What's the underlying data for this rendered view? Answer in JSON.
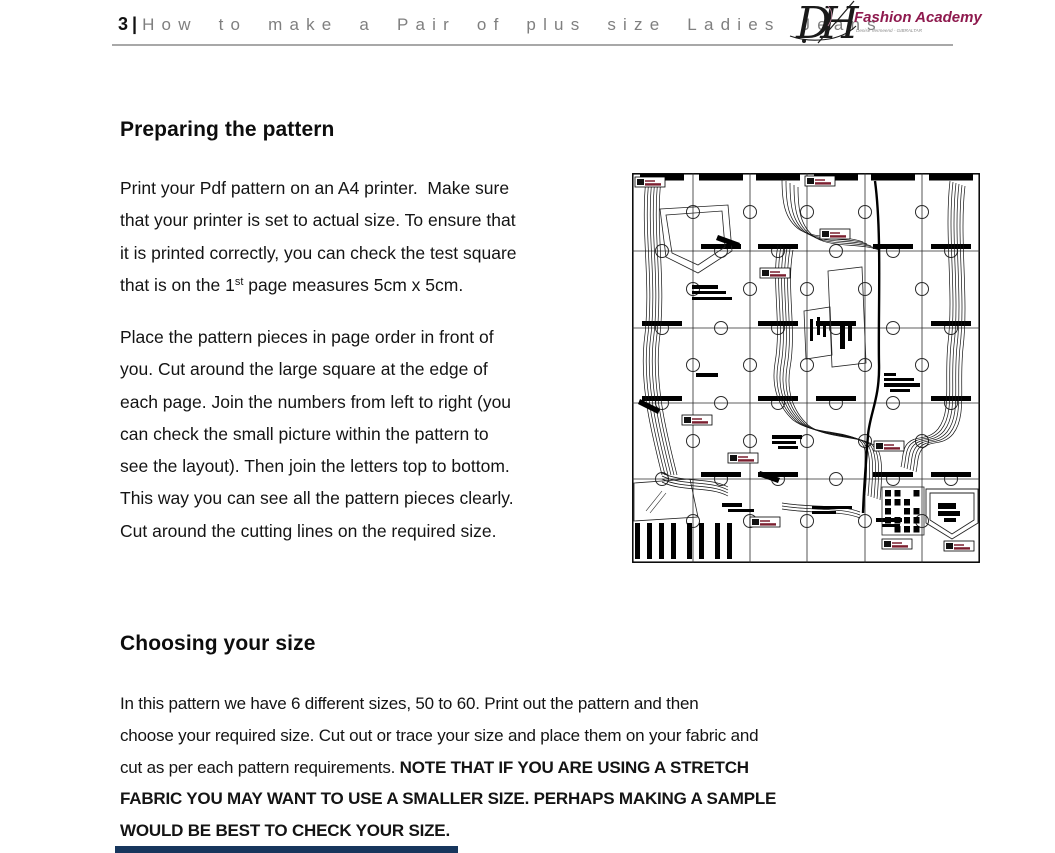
{
  "header": {
    "page_number": "3",
    "separator": "|",
    "title": "How to make a Pair of plus size Ladies Jeans",
    "logo": {
      "monogram": "DH",
      "name": "Fashion Academy",
      "tagline": "Denise Vermeend - GIBRALTAR",
      "name_color": "#8e1a4e"
    }
  },
  "sections": [
    {
      "heading": "Preparing the pattern",
      "para1_lines": [
        "Print your Pdf pattern on an A4 printer.  Make sure",
        "that your printer is set to actual size. To ensure that",
        "it is printed correctly, you can check the test square"
      ],
      "para1_last": {
        "pre": "that is on the 1",
        "sup": "st",
        "post": " page measures 5cm x 5cm."
      },
      "para2_lines": [
        "Place the pattern pieces in page order in front of",
        "you. Cut around the large square at the edge of",
        "each page. Join the numbers from left to right (you",
        "can check the small picture within the pattern to",
        "see the layout). Then join the letters top to bottom.",
        "This way you can see all the pattern pieces clearly.",
        "Cut around the cutting lines on the required size."
      ]
    },
    {
      "heading": "Choosing your size",
      "para_lines": [
        {
          "normal": "In this pattern we have 6 different sizes, 50 to 60. Print out the pattern and then",
          "bold": ""
        },
        {
          "normal": "choose your required size. Cut out or trace your size and place them on your fabric and",
          "bold": ""
        },
        {
          "normal": "cut as per each pattern requirements. ",
          "bold": "NOTE THAT IF YOU ARE USING A STRETCH"
        },
        {
          "normal": "",
          "bold": "FABRIC YOU MAY WANT TO USE A SMALLER SIZE. PERHAPS MAKING A SAMPLE"
        },
        {
          "normal": "",
          "bold": "WOULD BE BEST TO CHECK YOUR SIZE."
        }
      ]
    }
  ],
  "colors": {
    "brand_maroon": "#8e1a4e",
    "pattern_chip_maroon": "#7b1f2f",
    "cutoff_heading_navy": "#17365d",
    "header_title_gray": "#7f7f7f"
  }
}
